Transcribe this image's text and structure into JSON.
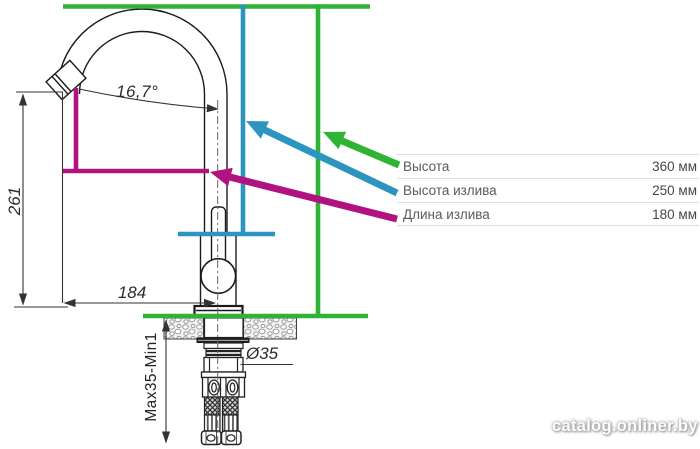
{
  "colors": {
    "green": "#2fb335",
    "cyan": "#2b95bf",
    "magenta": "#b01280"
  },
  "drawing_labels": {
    "angle": "16,7°",
    "overall_height": "261",
    "spout_reach": "184",
    "hole_diameter": "Ø35",
    "mount_range": "Max35-Min1"
  },
  "spec_table": {
    "rows": [
      {
        "label": "Высота",
        "value": "360 мм"
      },
      {
        "label": "Высота излива",
        "value": "250 мм"
      },
      {
        "label": "Длина излива",
        "value": "180 мм"
      }
    ]
  },
  "watermark": "catalog.onliner.by"
}
